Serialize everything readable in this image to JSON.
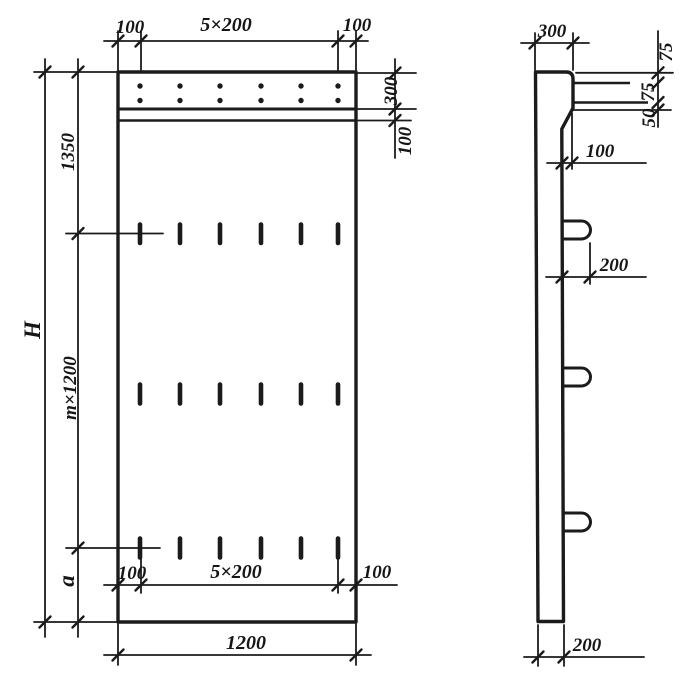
{
  "colors": {
    "ink": "#1b1b1b",
    "paper": "#ffffff"
  },
  "front_view": {
    "top_chain": {
      "left_margin": "100",
      "spacing": "5×200",
      "right_margin": "100"
    },
    "band_chain": {
      "band_height": "300",
      "band_lower": "100"
    },
    "height_chain": {
      "upper": "1350",
      "middle": "m×1200",
      "lower": "a",
      "overall": "H"
    },
    "bottom_chain": {
      "left_margin": "100",
      "spacing": "5×200",
      "right_margin": "100"
    },
    "overall_width": "1200"
  },
  "side_view": {
    "top_width": "300",
    "edge_chain": {
      "top": "75",
      "middle": "75",
      "bottom": "50"
    },
    "step_offset": "100",
    "loop_projection": "200",
    "bottom_thickness": "200"
  }
}
